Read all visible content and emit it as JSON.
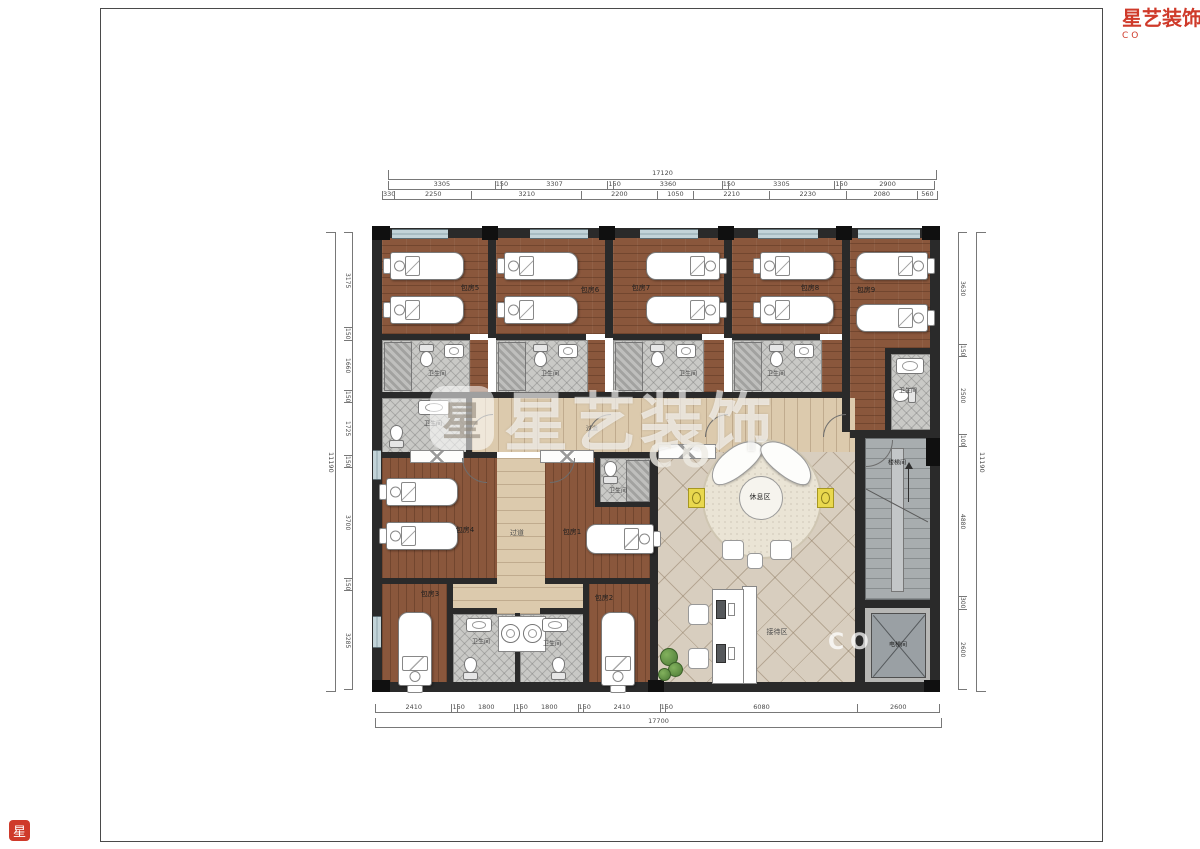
{
  "brand": {
    "name": "星艺装饰",
    "logo_char": "星",
    "sub_letters": "CO"
  },
  "labels": {
    "room5": "包房5",
    "room6": "包房6",
    "room7": "包房7",
    "room8": "包房8",
    "room9": "包房9",
    "room4": "包房4",
    "room1": "包房1",
    "room3": "包房3",
    "room2": "包房2",
    "bathroom": "卫生间",
    "corridor": "过道",
    "lounge": "休息区",
    "reception": "接待区",
    "stairwell": "楼梯间",
    "elevator": "电梯间"
  },
  "dimensions": {
    "top": {
      "total": "17120",
      "row1": [
        "3305",
        "150",
        "3307",
        "150",
        "3360",
        "150",
        "3305",
        "150",
        "2900"
      ],
      "row2": [
        "330",
        "2250",
        "3210",
        "2200",
        "1050",
        "2210",
        "2230",
        "2080",
        "560"
      ]
    },
    "bottom": {
      "total": "17700",
      "row": [
        "2410",
        "150",
        "1800",
        "150",
        "1800",
        "150",
        "2410",
        "150",
        "6080",
        "2600"
      ]
    },
    "left": {
      "total": "11190",
      "row": [
        "3175",
        "150",
        "1660",
        "150",
        "1725",
        "150",
        "3700",
        "150",
        "3285"
      ]
    },
    "right": {
      "total": "11190",
      "row": [
        "3630",
        "150",
        "2500",
        "100",
        "4880",
        "300",
        "2600"
      ]
    }
  }
}
